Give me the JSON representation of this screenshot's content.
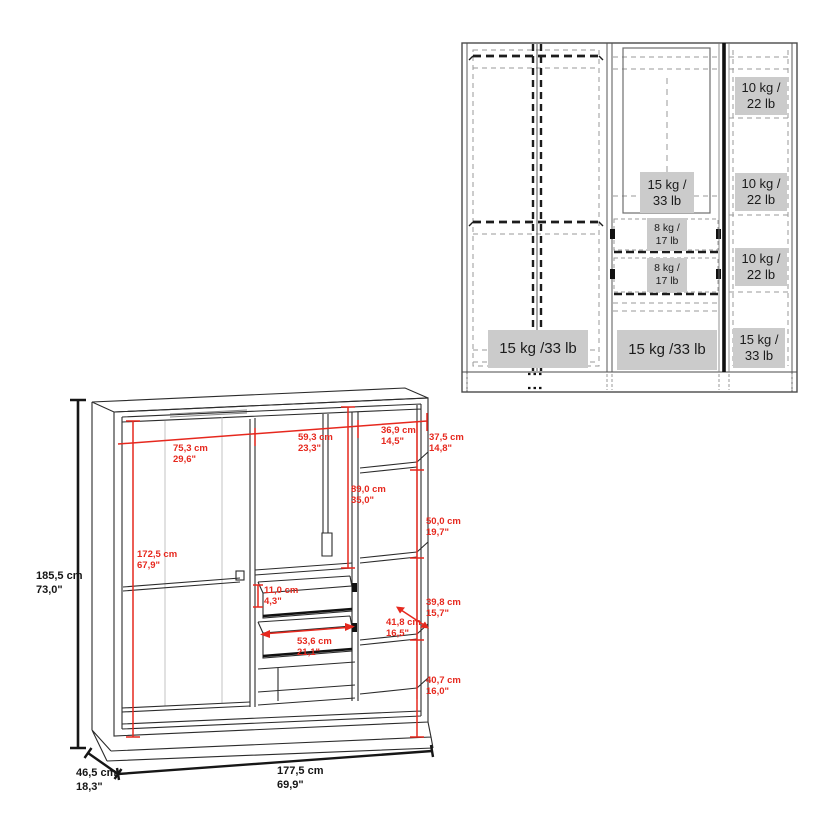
{
  "front_view": {
    "label_bg": "#cbcbcb",
    "labels": {
      "left_bottom": "15 kg /33 lb",
      "mirror": "15 kg /\n33 lb",
      "drawer_top": "8 kg /\n17 lb",
      "drawer_bottom": "8 kg /\n17 lb",
      "mid_bottom": "15 kg /33 lb",
      "right_top": "10 kg /\n22 lb",
      "right_mid": "10 kg /\n22 lb",
      "right_lower": "10 kg /\n22 lb",
      "right_bottom": "15 kg /\n33 lb"
    }
  },
  "dimension_view": {
    "accent_color": "#e6281e",
    "overall": {
      "height": "185,5 cm\n73,0\"",
      "depth": "46,5 cm\n18,3\"",
      "width": "177,5 cm\n69,9\""
    },
    "dims": {
      "left_opening_width": "75,3 cm\n29,6\"",
      "middle_opening_width": "59,3 cm\n23,3\"",
      "right_opening_width": "36,9 cm\n14,5\"",
      "right_top_shelf_height": "37,5 cm\n14,8\"",
      "middle_hang_height": "89,0 cm\n35,0\"",
      "right_shelf2_height": "50,0 cm\n19,7\"",
      "left_hang_height": "172,5 cm\n67,9\"",
      "drawer_height": "11,0 cm\n4,3\"",
      "right_shelf3_height": "39,8 cm\n15,7\"",
      "shelf_depth": "41,8 cm\n16,5\"",
      "drawer_width": "53,6 cm\n21,1\"",
      "right_bottom_height": "40,7 cm\n16,0\""
    }
  }
}
